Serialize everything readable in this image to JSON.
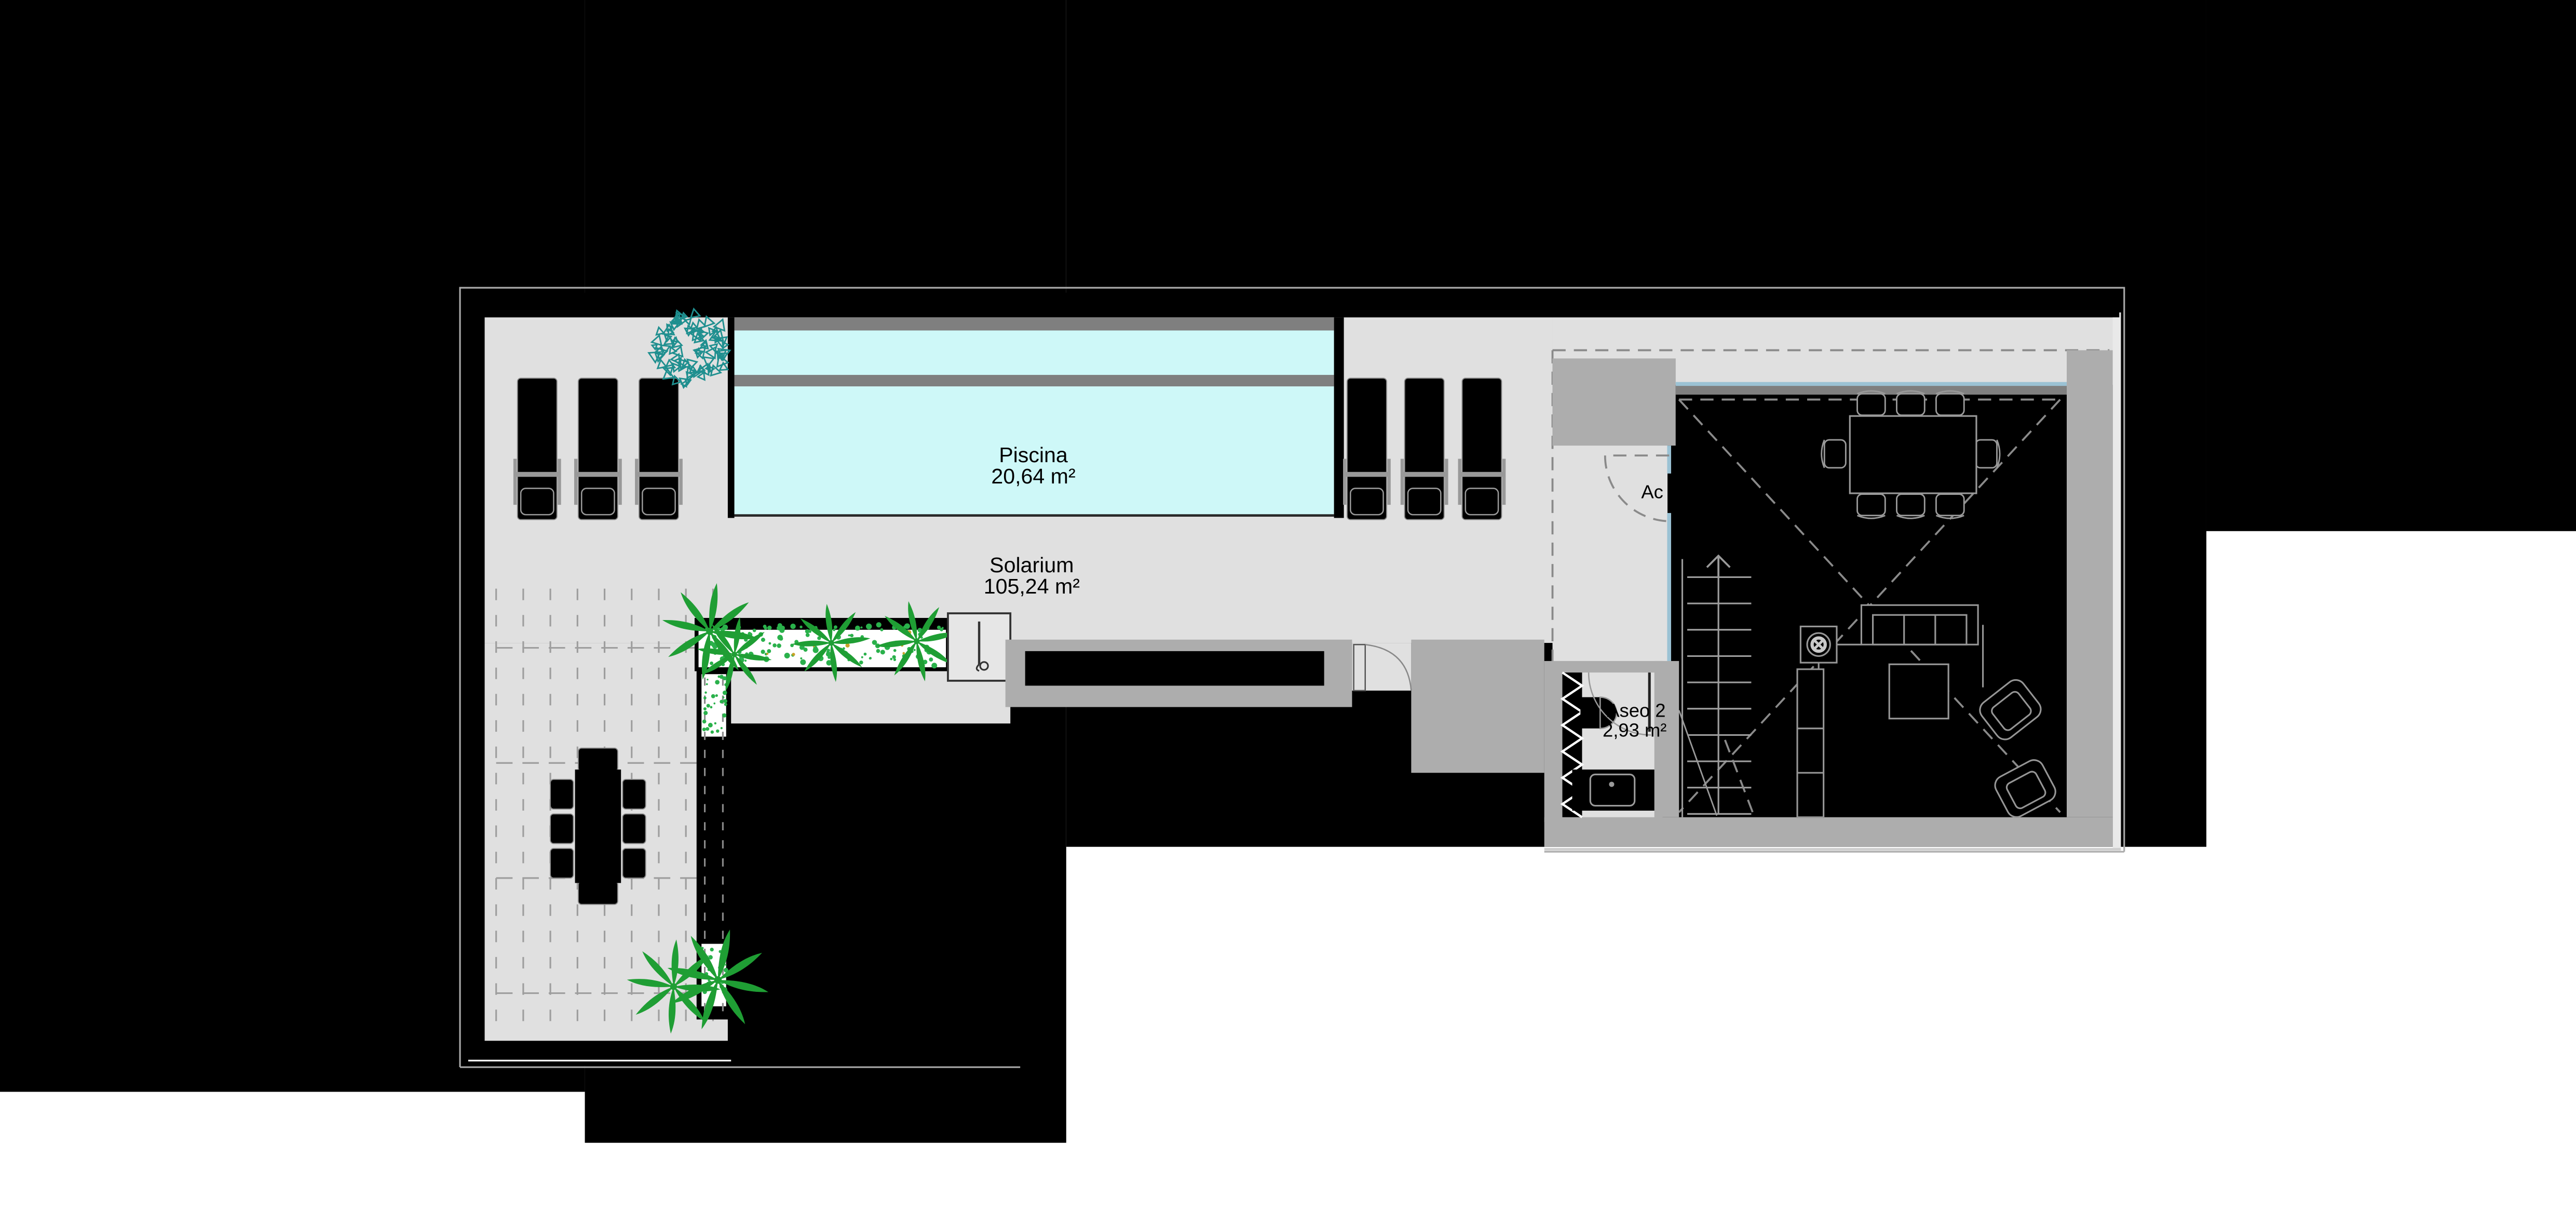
{
  "title": "floor-plan-solarium-level",
  "labels": {
    "piscina": {
      "name": "Piscina",
      "area": "20,64 m²"
    },
    "solarium": {
      "name": "Solarium",
      "area": "105,24 m²"
    },
    "aseo": {
      "name": "Aseo 2",
      "area": "2,93 m²"
    },
    "acceso": {
      "name": "Ac"
    }
  },
  "colors": {
    "page": "#ffffff",
    "mask": "#000000",
    "terrace": "#e0e0e0",
    "terrace_light": "#e9e9e9",
    "wall": "#adadad",
    "band": "#7f7f7f",
    "pool": "#cef8f8",
    "glass": "#9bc2d4",
    "outline": "#969696",
    "dash": "#8a8a8a",
    "plant": "#1f9e34",
    "scatter": "#2ab14b",
    "shrub": "#1f8f8f",
    "accent_yellow": "#c9a227"
  }
}
